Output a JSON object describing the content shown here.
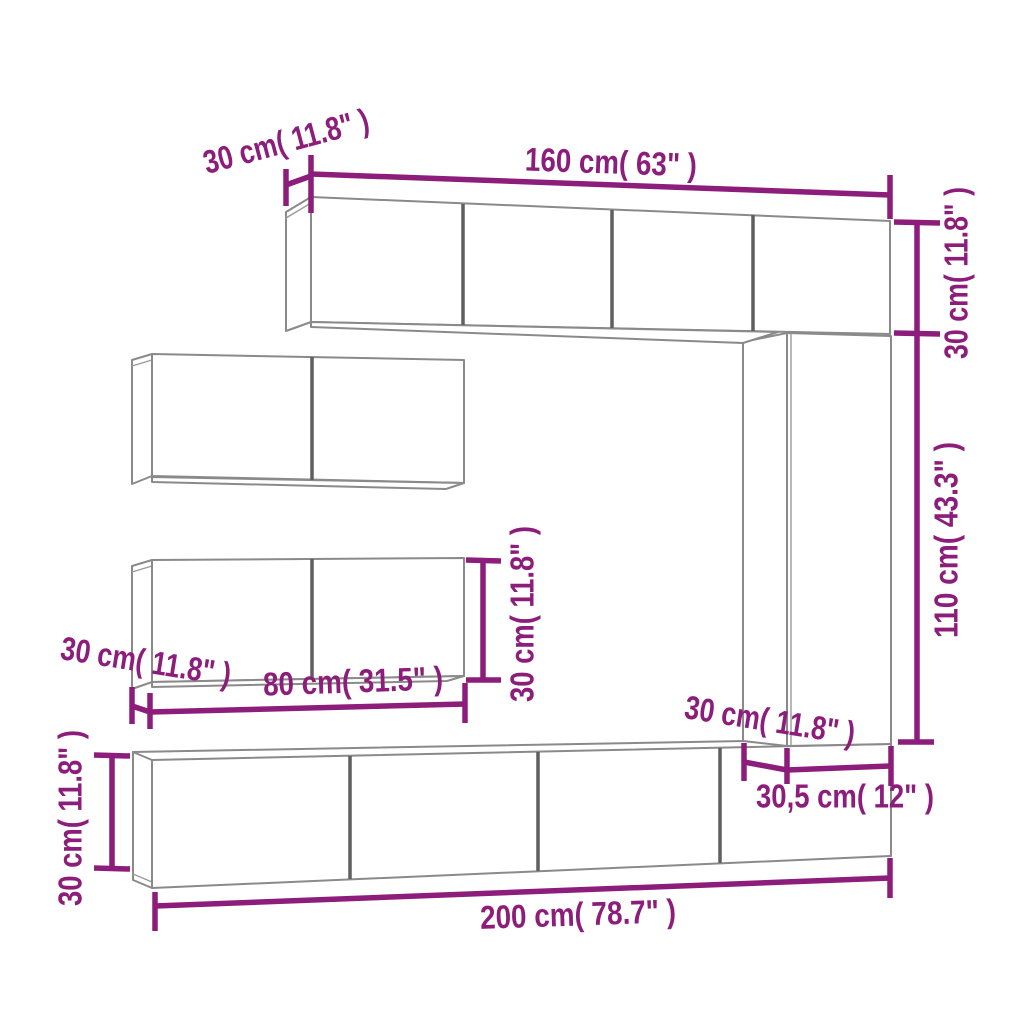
{
  "diagram": {
    "type": "furniture-dimension-diagram",
    "subject": "wall-mounted TV cabinet set",
    "accent_color": "#8C1D7B",
    "outline_color": "#8A8A8A",
    "background_color": "#FFFFFF",
    "dimensions": {
      "top_cabinet_depth": "30 cm( 11.8\" )",
      "top_cabinet_width": "160 cm( 63\" )",
      "top_cabinet_height": "30 cm( 11.8\" )",
      "right_column_height": "110 cm( 43.3\" )",
      "left_cabinet_depth": "30 cm( 11.8\" )",
      "left_cabinet_width": "80 cm( 31.5\" )",
      "left_cabinet_height": "30 cm( 11.8\" )",
      "column_depth": "30 cm( 11.8\" )",
      "column_width": "30,5 cm( 12\" )",
      "bottom_cabinet_width": "200 cm( 78.7\" )",
      "bottom_cabinet_height": "30 cm( 11.8\" )"
    }
  }
}
